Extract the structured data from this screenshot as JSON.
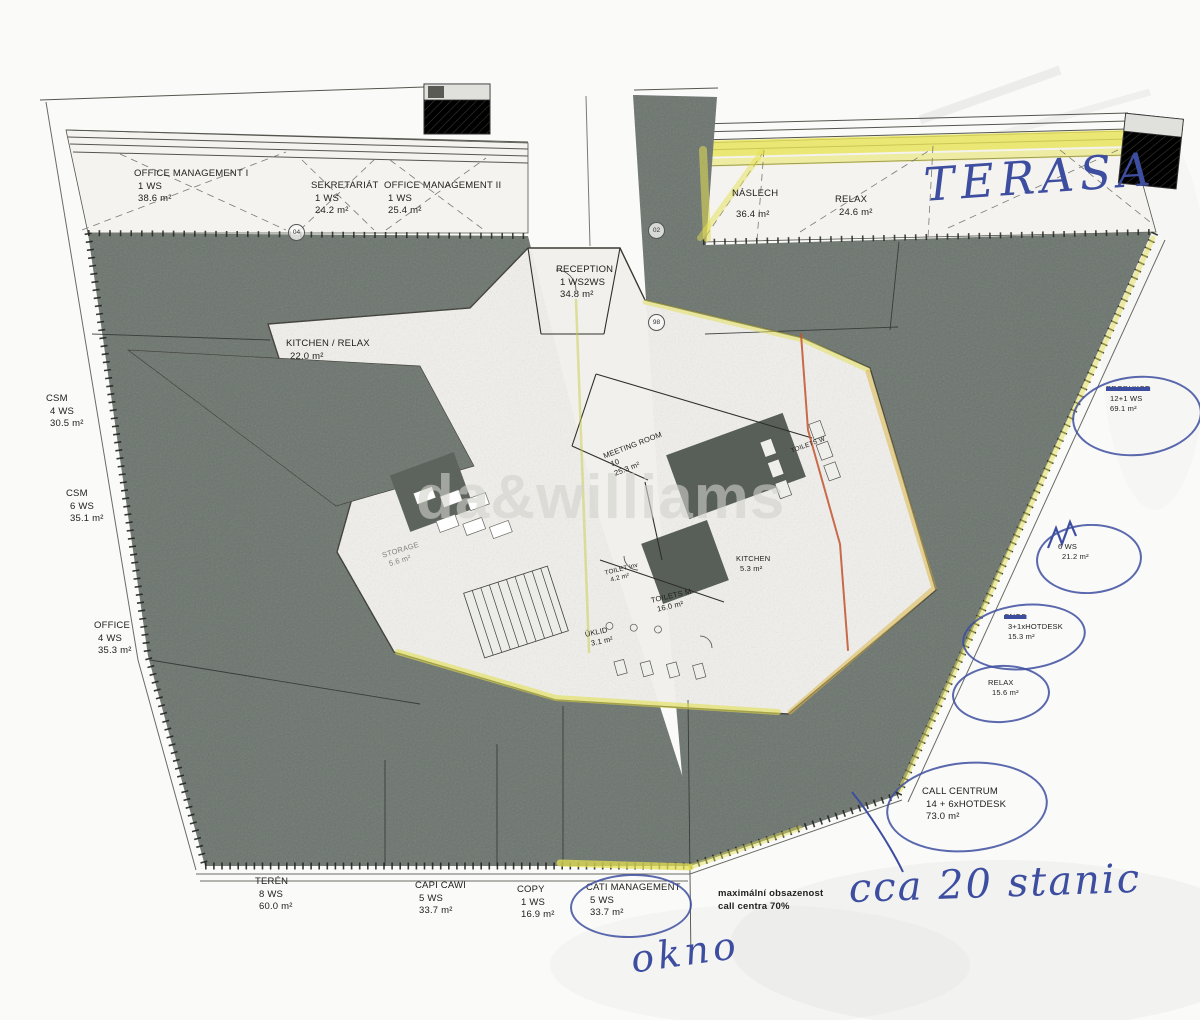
{
  "watermark": {
    "text": "da&williams"
  },
  "rooms": {
    "office_management_1": {
      "name": "OFFICE MANAGEMENT I",
      "ws": "1 WS",
      "area": "38.6 m²"
    },
    "sekretariat": {
      "name": "SEKRETARIÁT",
      "ws": "1 WS",
      "area": "24.2 m²"
    },
    "office_management_2": {
      "name": "OFFICE MANAGEMENT II",
      "ws": "1 WS",
      "area": "25.4 m²"
    },
    "reception": {
      "name": "RECEPTION",
      "ws": "1 WS2WS",
      "area": "34.8 m²"
    },
    "kitchen_relax": {
      "name": "KITCHEN / RELAX",
      "area": "22.0 m²"
    },
    "naslech": {
      "name": "NÁSLECH",
      "area": "36.4 m²"
    },
    "relax_top": {
      "name": "RELAX",
      "area": "24.6 m²"
    },
    "csm_4ws": {
      "name": "CSM",
      "ws": "4 WS",
      "area": "30.5 m²"
    },
    "csm_6ws": {
      "name": "CSM",
      "ws": "6 WS",
      "area": "35.1 m²"
    },
    "office_4ws": {
      "name": "OFFICE",
      "ws": "4 WS",
      "area": "35.3 m²"
    },
    "meeting_room": {
      "name": "MEETING ROOM",
      "ws": "10",
      "area": "25.3 m²"
    },
    "storage": {
      "name": "STORAGE",
      "area": "5.6 m²"
    },
    "kitchen_core": {
      "name": "KITCHEN",
      "area": "5.3 m²"
    },
    "toilet_inv": {
      "name": "TOILET inv",
      "area": "4.2 m²"
    },
    "toilets_m": {
      "name": "TOILETS M",
      "area": "16.0 m²"
    },
    "toilets_w": {
      "name": "TOILETS W"
    },
    "uklid": {
      "name": "ÚKLID",
      "area": "3.1 m²"
    },
    "teren": {
      "name": "TERÉN",
      "ws": "8 WS",
      "area": "60.0 m²"
    },
    "capi_cawi": {
      "name": "CAPI CAWI",
      "ws": "5 WS",
      "area": "33.7 m²"
    },
    "copy": {
      "name": "COPY",
      "ws": "1 WS",
      "area": "16.9 m²"
    },
    "cati_management": {
      "name": "CATI MANAGEMENT",
      "ws": "5 WS",
      "area": "33.7 m²"
    },
    "produkce": {
      "name": "PRODUKCE",
      "ws": "12+1 WS",
      "area": "69.1 m²"
    },
    "it": {
      "ws": "6 WS",
      "area": "21.2 m²"
    },
    "cncc": {
      "name": "CNCC",
      "ws": "3+1xHOTDESK",
      "area": "15.3 m²"
    },
    "relax_right": {
      "name": "RELAX",
      "area": "15.6 m²"
    },
    "call_centrum": {
      "name": "CALL CENTRUM",
      "ws": "14 + 6xHOTDESK",
      "area": "73.0 m²"
    }
  },
  "notes": {
    "max_occupancy_line1": "maximální obsazenost",
    "max_occupancy_line2": "call centra 70%"
  },
  "handwritten": {
    "terasa": "TERASA",
    "cca_20_stanic": "cca 20 stanic",
    "okno": "okno"
  },
  "markers": {
    "door_left": "04",
    "door_center": "02",
    "door_lower": "98"
  },
  "colors": {
    "highlight_yellow": "#e3df52",
    "ink_blue": "#3d4da0",
    "openspace_gray": "#6c746e",
    "accent_orange": "#c2532e"
  }
}
